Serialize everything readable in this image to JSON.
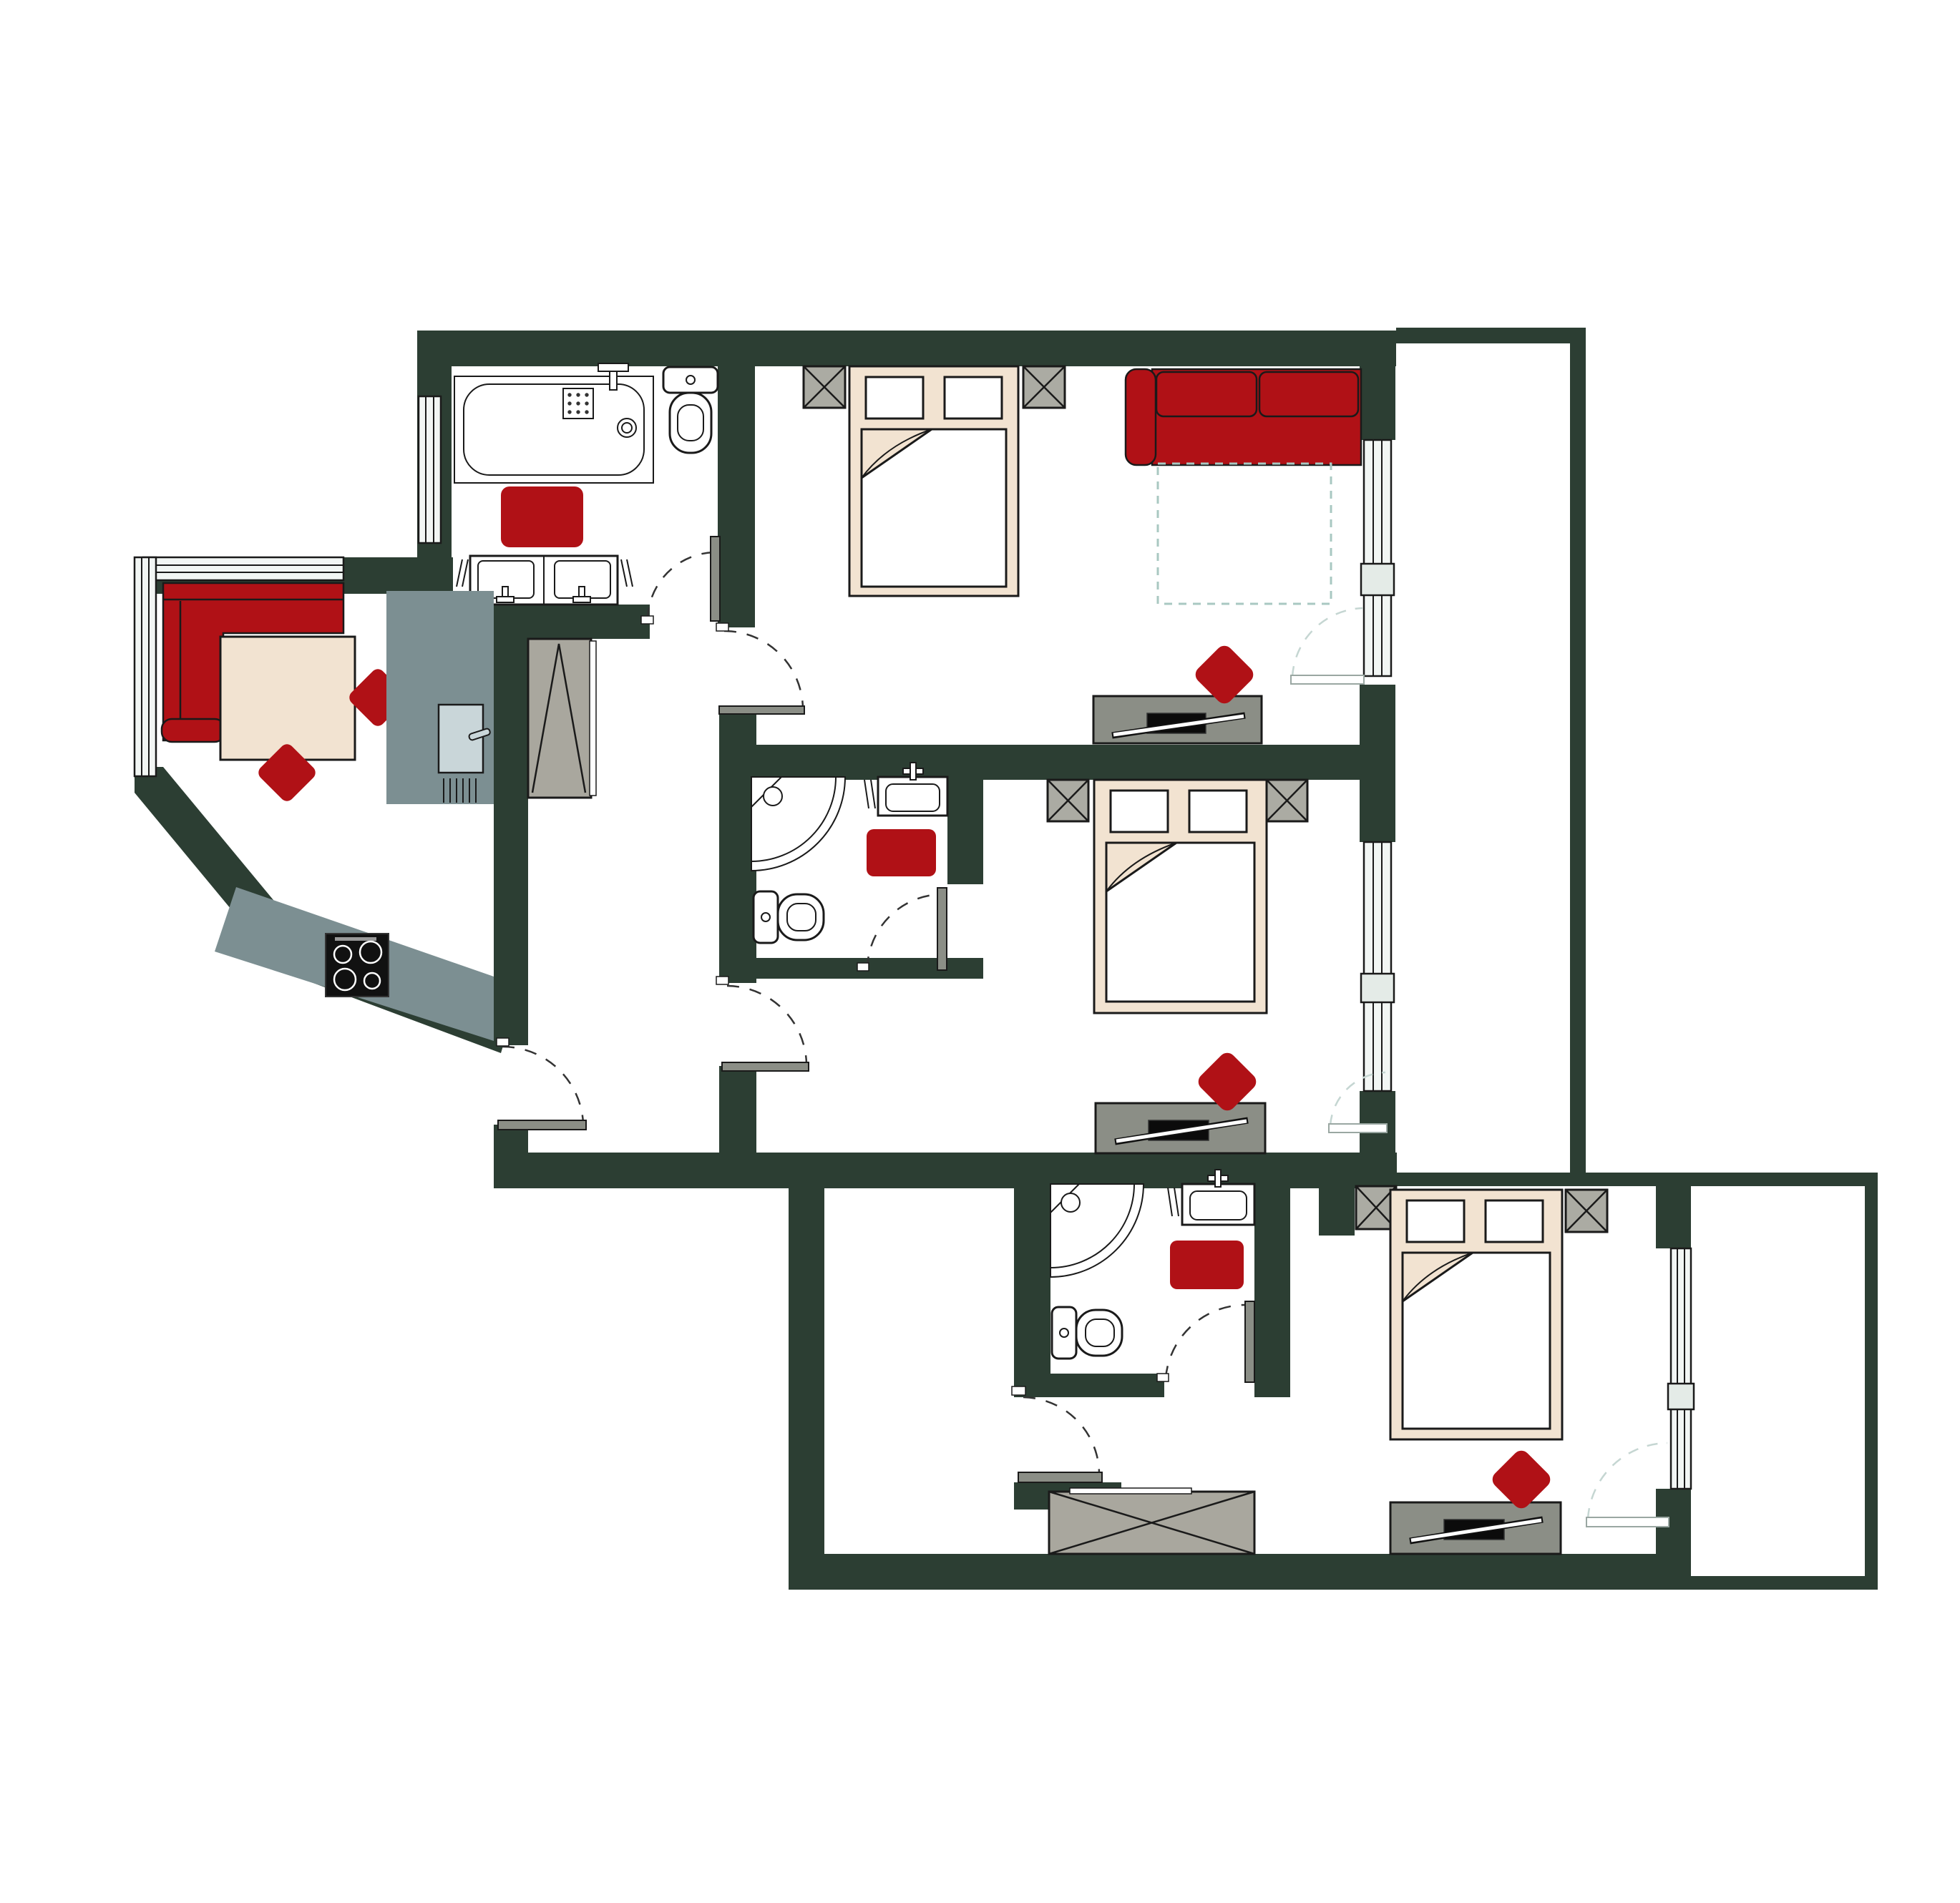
{
  "document": {
    "kind": "architectural-floor-plan",
    "description": "Top-down color floor plan of an apartment suite with three bed units, three bathrooms, an open living-dining-kitchen wing and two balconies. No text labels are printed on the drawing.",
    "wall_color_name": "dark pine green",
    "accent_color_name": "crimson red"
  },
  "palette": {
    "wall": "#2C3E33",
    "accent": "#B01116",
    "beige": "#F2E3D1",
    "furn": "#ABABA3",
    "dresser": "#8B8E86",
    "wardrobe": "#A9A79E",
    "counter": "#7C8F92",
    "glass": "#F2F6F4",
    "glass2": "#E4EBE7",
    "line": "#1A1A1A",
    "arcdark": "#333333",
    "arclight": "#C5D6D2",
    "pullout": "#A9C8C2",
    "sinkpanel": "#C9D6D9"
  },
  "rooms": [
    {
      "name": "bathroom-1",
      "fixtures": [
        "bathtub",
        "toilet",
        "double-sink-vanity",
        "red-bath-mat",
        "window",
        "door"
      ]
    },
    {
      "name": "bedroom-1-living",
      "fixtures": [
        "double-bed",
        "2 nightstands",
        "red-sofa-with-pullout",
        "tv-dresser",
        "red-cushion",
        "french-window-to-balcony"
      ]
    },
    {
      "name": "living-dining-kitchen-wing",
      "fixtures": [
        "corner-red-sofa",
        "dining-table",
        "2 red-chairs",
        "kitchen-counter",
        "kitchen-sink",
        "cooktop-4-burners",
        "corner-windows",
        "tall-wardrobe"
      ]
    },
    {
      "name": "bathroom-2",
      "fixtures": [
        "corner-shower",
        "toilet",
        "sink",
        "red-bath-mat",
        "door"
      ]
    },
    {
      "name": "bedroom-2",
      "fixtures": [
        "double-bed",
        "2 nightstands",
        "tv-dresser",
        "red-cushion",
        "french-window-to-balcony",
        "door"
      ]
    },
    {
      "name": "bathroom-3",
      "fixtures": [
        "corner-shower",
        "toilet",
        "sink",
        "red-bath-mat",
        "door"
      ]
    },
    {
      "name": "bedroom-3",
      "fixtures": [
        "double-bed",
        "2 nightstands",
        "tv-dresser",
        "red-cushion",
        "french-window-to-balcony"
      ]
    },
    {
      "name": "entry-hall-lower",
      "fixtures": [
        "wide-wardrobe",
        "entrance-door"
      ]
    },
    {
      "name": "balcony-top-right",
      "fixtures": []
    },
    {
      "name": "balcony-bottom-right",
      "fixtures": []
    }
  ],
  "counts": {
    "beds": 3,
    "bathtubs": 1,
    "showers": 2,
    "toilets": 3,
    "sinks": 4,
    "sofas": 2,
    "wardrobes": 2,
    "nightstands": 6,
    "tv_dressers": 3,
    "red_bath_mats": 3,
    "red_cushions": 3,
    "dining_chairs": 2,
    "balconies": 2,
    "cooktop_burners": 4,
    "interior_doors": 7,
    "french_windows": 3,
    "fixed_windows": 3
  }
}
